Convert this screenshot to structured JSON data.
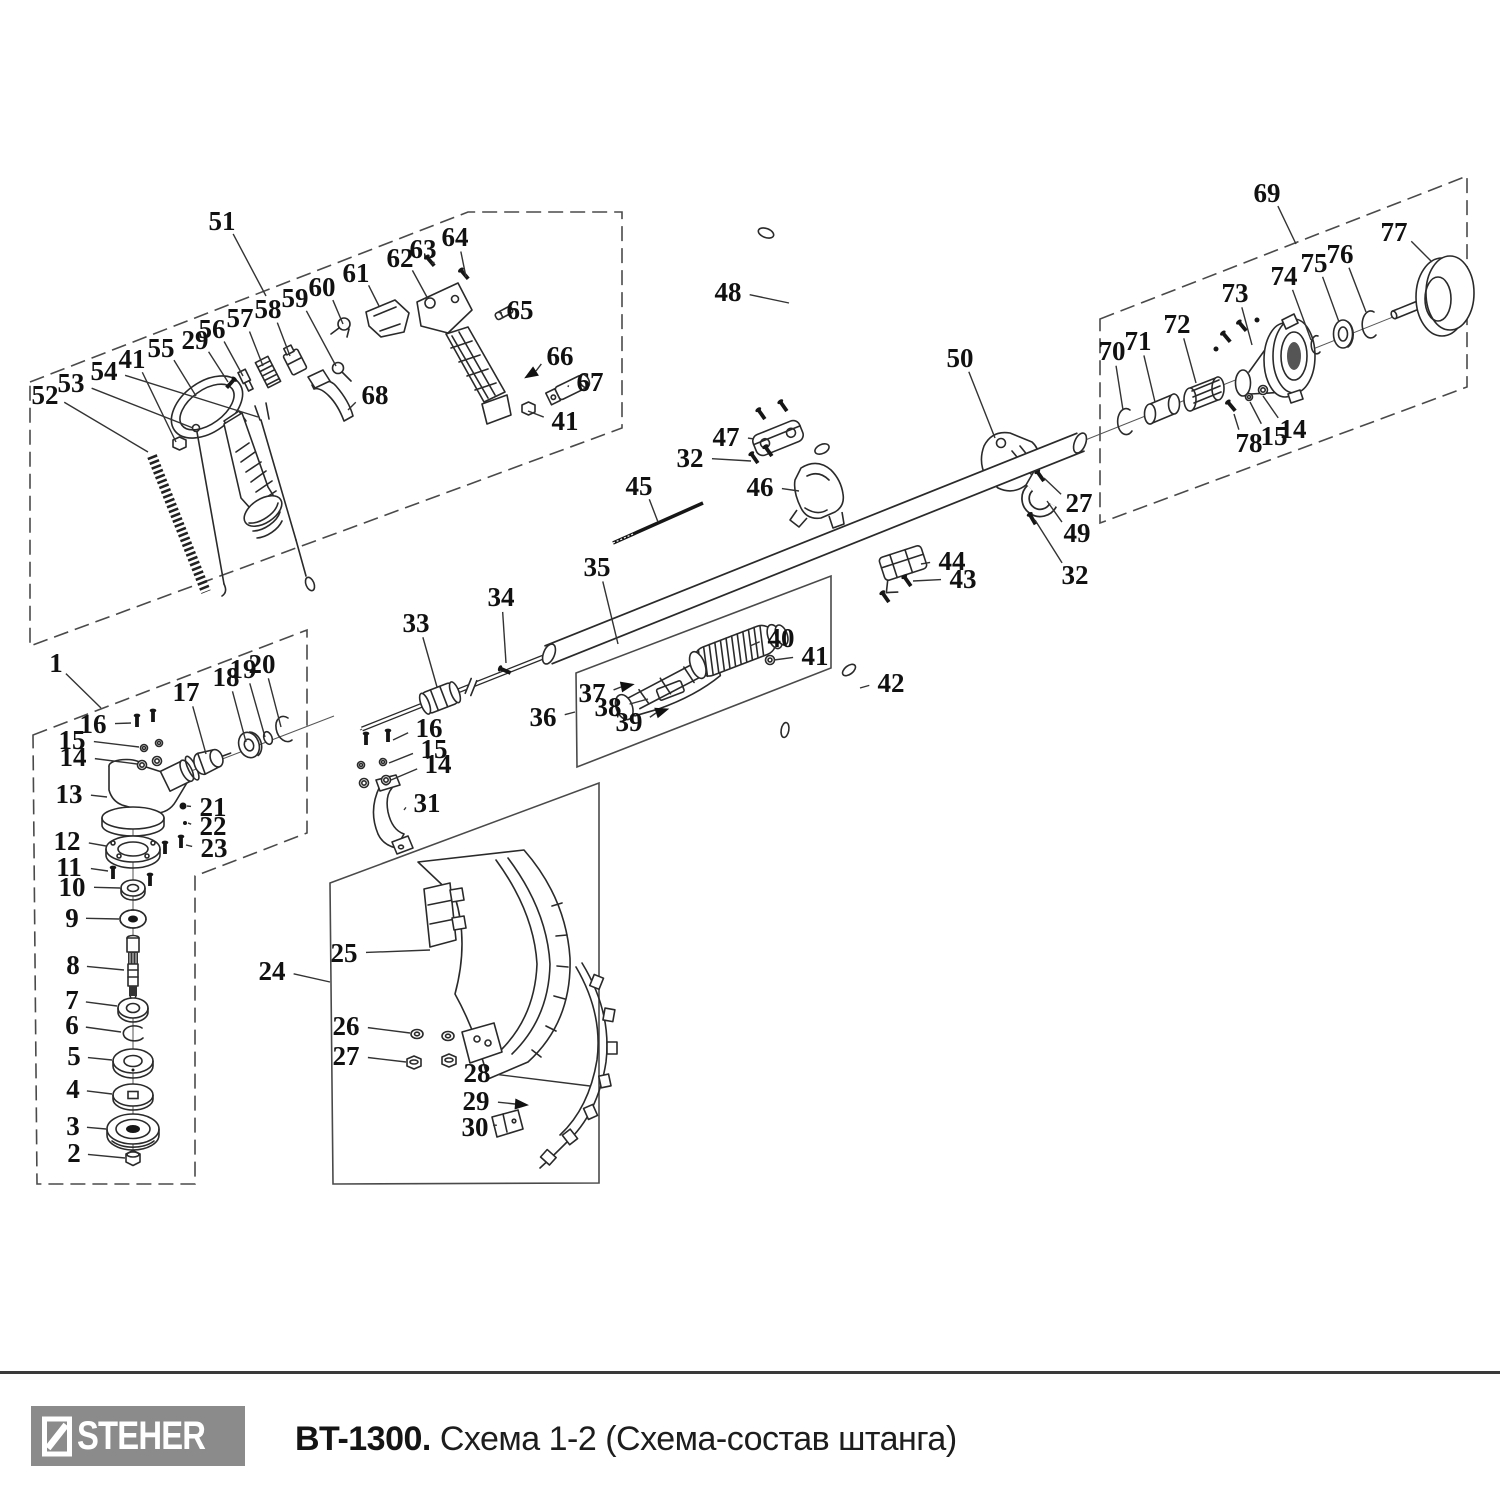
{
  "footer": {
    "brand": "STEHER",
    "model": "BT-1300.",
    "subtitle": "Схема 1-2 (Схема-состав штанга)",
    "logo_bg": "#8b8b8b",
    "logo_fg": "#ffffff",
    "divider_color": "#3a3a3a"
  },
  "diagram": {
    "ink": "#2a2a2a",
    "leader_color": "#333333",
    "callouts": [
      {
        "n": "51",
        "x": 222,
        "y": 221,
        "tx": 266,
        "ty": 296
      },
      {
        "n": "52",
        "x": 45,
        "y": 395,
        "tx": 148,
        "ty": 452
      },
      {
        "n": "53",
        "x": 71,
        "y": 383,
        "tx": 193,
        "ty": 428
      },
      {
        "n": "54",
        "x": 104,
        "y": 371,
        "tx": 258,
        "ty": 417
      },
      {
        "n": "41",
        "x": 132,
        "y": 359,
        "tx": 176,
        "ty": 442
      },
      {
        "n": "55",
        "x": 161,
        "y": 348,
        "tx": 196,
        "ty": 396
      },
      {
        "n": "29",
        "x": 195,
        "y": 340,
        "tx": 228,
        "ty": 382
      },
      {
        "n": "56",
        "x": 212,
        "y": 329,
        "tx": 243,
        "ty": 376
      },
      {
        "n": "57",
        "x": 240,
        "y": 318,
        "tx": 263,
        "ty": 366
      },
      {
        "n": "58",
        "x": 268,
        "y": 309,
        "tx": 290,
        "ty": 356
      },
      {
        "n": "59",
        "x": 295,
        "y": 298,
        "tx": 336,
        "ty": 366
      },
      {
        "n": "60",
        "x": 322,
        "y": 287,
        "tx": 343,
        "ty": 324
      },
      {
        "n": "61",
        "x": 356,
        "y": 273,
        "tx": 379,
        "ty": 306
      },
      {
        "n": "62",
        "x": 400,
        "y": 258,
        "tx": 428,
        "ty": 299
      },
      {
        "n": "63",
        "x": 423,
        "y": 249,
        "tx": 432,
        "ty": 264
      },
      {
        "n": "64",
        "x": 455,
        "y": 237,
        "tx": 466,
        "ty": 277
      },
      {
        "n": "65",
        "x": 520,
        "y": 310,
        "tx": 502,
        "ty": 313
      },
      {
        "n": "66",
        "x": 560,
        "y": 356,
        "tx": 536,
        "ty": 371,
        "arrow": true
      },
      {
        "n": "67",
        "x": 590,
        "y": 382,
        "tx": 568,
        "ty": 387
      },
      {
        "n": "68",
        "x": 375,
        "y": 395,
        "tx": 348,
        "ty": 410
      },
      {
        "n": "41",
        "x": 565,
        "y": 421,
        "tx": 528,
        "ty": 411
      },
      {
        "n": "69",
        "x": 1267,
        "y": 193,
        "tx": 1296,
        "ty": 244
      },
      {
        "n": "70",
        "x": 1112,
        "y": 351,
        "tx": 1123,
        "ty": 410
      },
      {
        "n": "71",
        "x": 1138,
        "y": 341,
        "tx": 1155,
        "ty": 402
      },
      {
        "n": "72",
        "x": 1177,
        "y": 324,
        "tx": 1196,
        "ty": 383
      },
      {
        "n": "73",
        "x": 1235,
        "y": 293,
        "tx": 1252,
        "ty": 345
      },
      {
        "n": "74",
        "x": 1284,
        "y": 276,
        "tx": 1311,
        "ty": 340
      },
      {
        "n": "75",
        "x": 1314,
        "y": 263,
        "tx": 1339,
        "ty": 322
      },
      {
        "n": "76",
        "x": 1340,
        "y": 254,
        "tx": 1366,
        "ty": 312
      },
      {
        "n": "77",
        "x": 1394,
        "y": 232,
        "tx": 1432,
        "ty": 262
      },
      {
        "n": "78",
        "x": 1249,
        "y": 443,
        "tx": 1234,
        "ty": 414
      },
      {
        "n": "15",
        "x": 1274,
        "y": 436,
        "tx": 1250,
        "ty": 402
      },
      {
        "n": "14",
        "x": 1293,
        "y": 429,
        "tx": 1263,
        "ty": 396
      },
      {
        "n": "48",
        "x": 728,
        "y": 292,
        "tx": 789,
        "ty": 303
      },
      {
        "n": "47",
        "x": 726,
        "y": 437,
        "tx": 754,
        "ty": 439
      },
      {
        "n": "32",
        "x": 690,
        "y": 458,
        "tx": 751,
        "ty": 461
      },
      {
        "n": "46",
        "x": 760,
        "y": 487,
        "tx": 799,
        "ty": 491
      },
      {
        "n": "45",
        "x": 639,
        "y": 486,
        "tx": 658,
        "ty": 522
      },
      {
        "n": "50",
        "x": 960,
        "y": 358,
        "tx": 995,
        "ty": 438
      },
      {
        "n": "27",
        "x": 1079,
        "y": 503,
        "tx": 1044,
        "ty": 478
      },
      {
        "n": "49",
        "x": 1077,
        "y": 533,
        "tx": 1047,
        "ty": 501
      },
      {
        "n": "32",
        "x": 1075,
        "y": 575,
        "tx": 1035,
        "ty": 520
      },
      {
        "n": "44",
        "x": 952,
        "y": 561,
        "tx": 921,
        "ty": 564
      },
      {
        "n": "43",
        "x": 963,
        "y": 579,
        "tx": 913,
        "ty": 581
      },
      {
        "n": "33",
        "x": 416,
        "y": 623,
        "tx": 437,
        "ty": 687
      },
      {
        "n": "34",
        "x": 501,
        "y": 597,
        "tx": 506,
        "ty": 663
      },
      {
        "n": "35",
        "x": 597,
        "y": 567,
        "tx": 618,
        "ty": 644
      },
      {
        "n": "36",
        "x": 543,
        "y": 717,
        "tx": 575,
        "ty": 712
      },
      {
        "n": "37",
        "x": 592,
        "y": 693,
        "tx": 621,
        "ty": 687,
        "arrow": true
      },
      {
        "n": "38",
        "x": 608,
        "y": 707,
        "tx": 648,
        "ty": 699
      },
      {
        "n": "39",
        "x": 629,
        "y": 722,
        "tx": 656,
        "ty": 713,
        "arrow": true
      },
      {
        "n": "40",
        "x": 781,
        "y": 638,
        "tx": 750,
        "ty": 646
      },
      {
        "n": "41",
        "x": 815,
        "y": 656,
        "tx": 774,
        "ty": 660
      },
      {
        "n": "42",
        "x": 891,
        "y": 683,
        "tx": 860,
        "ty": 688
      },
      {
        "n": "16",
        "x": 429,
        "y": 728,
        "tx": 393,
        "ty": 740
      },
      {
        "n": "15",
        "x": 434,
        "y": 749,
        "tx": 389,
        "ty": 763
      },
      {
        "n": "14",
        "x": 438,
        "y": 764,
        "tx": 391,
        "ty": 780
      },
      {
        "n": "31",
        "x": 427,
        "y": 803,
        "tx": 404,
        "ty": 810
      },
      {
        "n": "1",
        "x": 56,
        "y": 663,
        "tx": 101,
        "ty": 708
      },
      {
        "n": "16",
        "x": 93,
        "y": 724,
        "tx": 131,
        "ty": 723
      },
      {
        "n": "15",
        "x": 72,
        "y": 740,
        "tx": 139,
        "ty": 747
      },
      {
        "n": "14",
        "x": 73,
        "y": 757,
        "tx": 137,
        "ty": 764
      },
      {
        "n": "17",
        "x": 186,
        "y": 692,
        "tx": 206,
        "ty": 754
      },
      {
        "n": "18",
        "x": 226,
        "y": 677,
        "tx": 246,
        "ty": 742
      },
      {
        "n": "19",
        "x": 243,
        "y": 669,
        "tx": 265,
        "ty": 737
      },
      {
        "n": "20",
        "x": 262,
        "y": 664,
        "tx": 281,
        "ty": 727
      },
      {
        "n": "13",
        "x": 69,
        "y": 794,
        "tx": 107,
        "ty": 797
      },
      {
        "n": "21",
        "x": 213,
        "y": 807,
        "tx": 187,
        "ty": 806
      },
      {
        "n": "22",
        "x": 213,
        "y": 826,
        "tx": 188,
        "ty": 823
      },
      {
        "n": "23",
        "x": 214,
        "y": 848,
        "tx": 186,
        "ty": 845
      },
      {
        "n": "12",
        "x": 67,
        "y": 841,
        "tx": 106,
        "ty": 846
      },
      {
        "n": "11",
        "x": 69,
        "y": 867,
        "tx": 108,
        "ty": 871
      },
      {
        "n": "10",
        "x": 72,
        "y": 887,
        "tx": 120,
        "ty": 888
      },
      {
        "n": "9",
        "x": 72,
        "y": 918,
        "tx": 119,
        "ty": 919
      },
      {
        "n": "8",
        "x": 73,
        "y": 965,
        "tx": 124,
        "ty": 970
      },
      {
        "n": "7",
        "x": 72,
        "y": 1000,
        "tx": 117,
        "ty": 1006
      },
      {
        "n": "6",
        "x": 72,
        "y": 1025,
        "tx": 121,
        "ty": 1032
      },
      {
        "n": "5",
        "x": 74,
        "y": 1056,
        "tx": 112,
        "ty": 1060
      },
      {
        "n": "4",
        "x": 73,
        "y": 1089,
        "tx": 112,
        "ty": 1094
      },
      {
        "n": "3",
        "x": 73,
        "y": 1126,
        "tx": 106,
        "ty": 1129
      },
      {
        "n": "2",
        "x": 74,
        "y": 1153,
        "tx": 125,
        "ty": 1158
      },
      {
        "n": "24",
        "x": 272,
        "y": 971,
        "tx": 330,
        "ty": 982
      },
      {
        "n": "25",
        "x": 344,
        "y": 953,
        "tx": 430,
        "ty": 950
      },
      {
        "n": "26",
        "x": 346,
        "y": 1026,
        "tx": 410,
        "ty": 1033
      },
      {
        "n": "27",
        "x": 346,
        "y": 1056,
        "tx": 406,
        "ty": 1062
      },
      {
        "n": "28",
        "x": 477,
        "y": 1073,
        "tx": 590,
        "ty": 1086
      },
      {
        "n": "29",
        "x": 476,
        "y": 1101,
        "tx": 515,
        "ty": 1104,
        "arrow": true
      },
      {
        "n": "30",
        "x": 475,
        "y": 1127,
        "tx": 493,
        "ty": 1125
      }
    ]
  }
}
